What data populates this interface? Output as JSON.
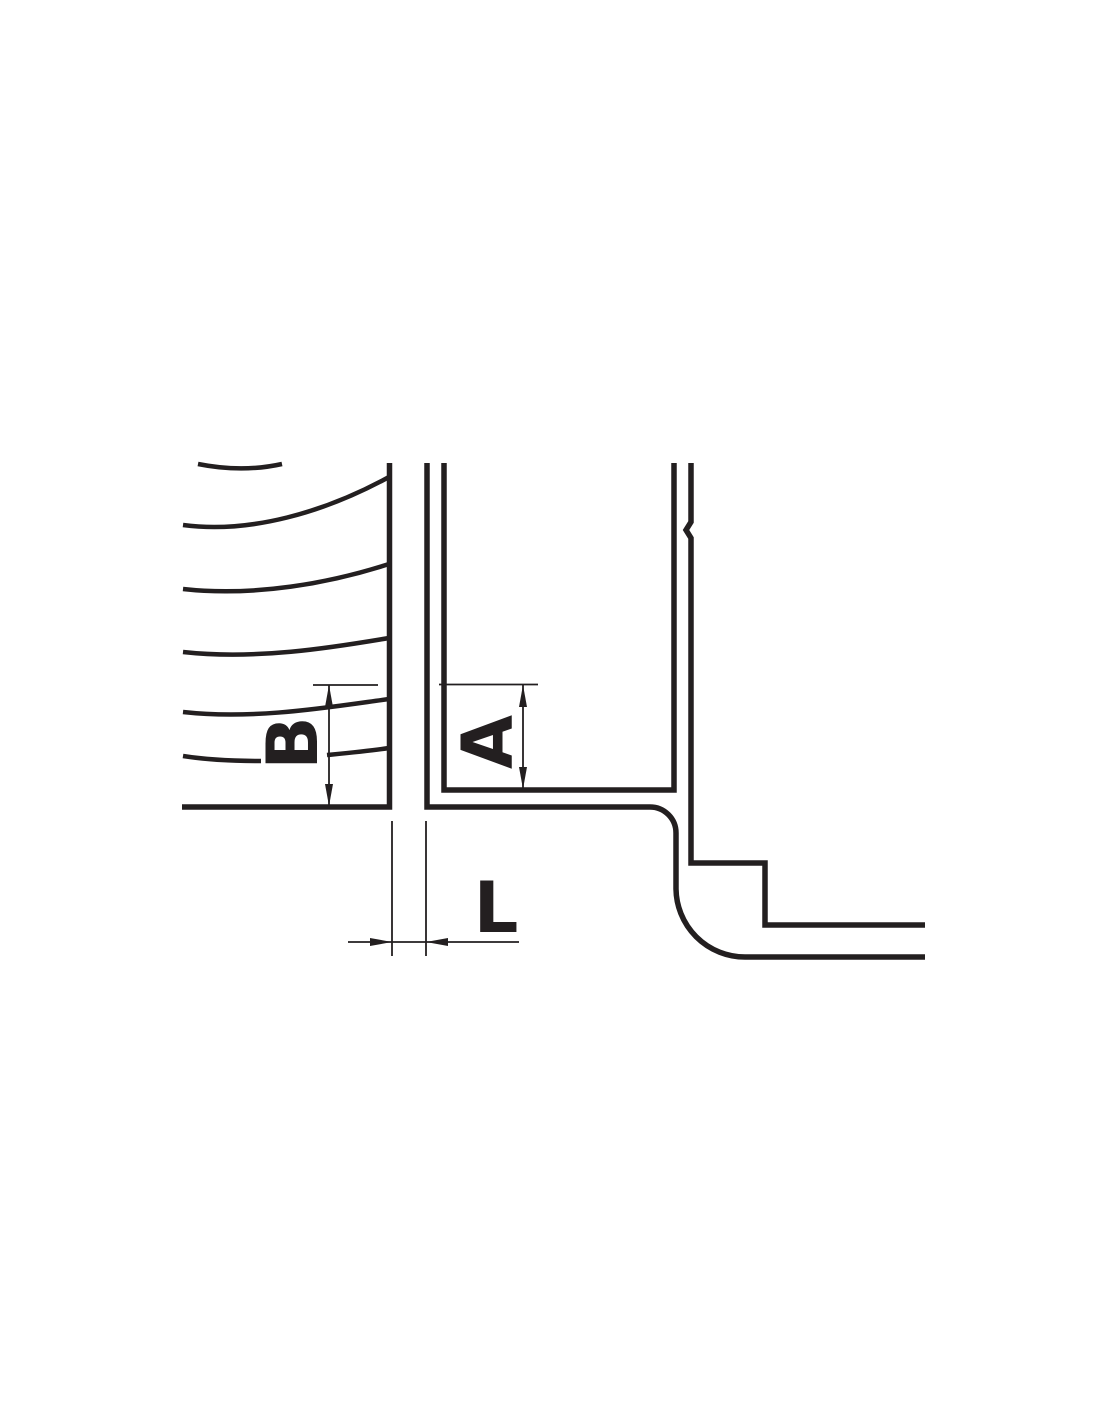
{
  "diagram": {
    "description": "engineering-cross-section-drawing",
    "background_color": "#ffffff",
    "line_color": "#231f20",
    "dimensions": {
      "b": {
        "label": "B"
      },
      "a": {
        "label": "A"
      },
      "l": {
        "label": "L"
      }
    }
  }
}
